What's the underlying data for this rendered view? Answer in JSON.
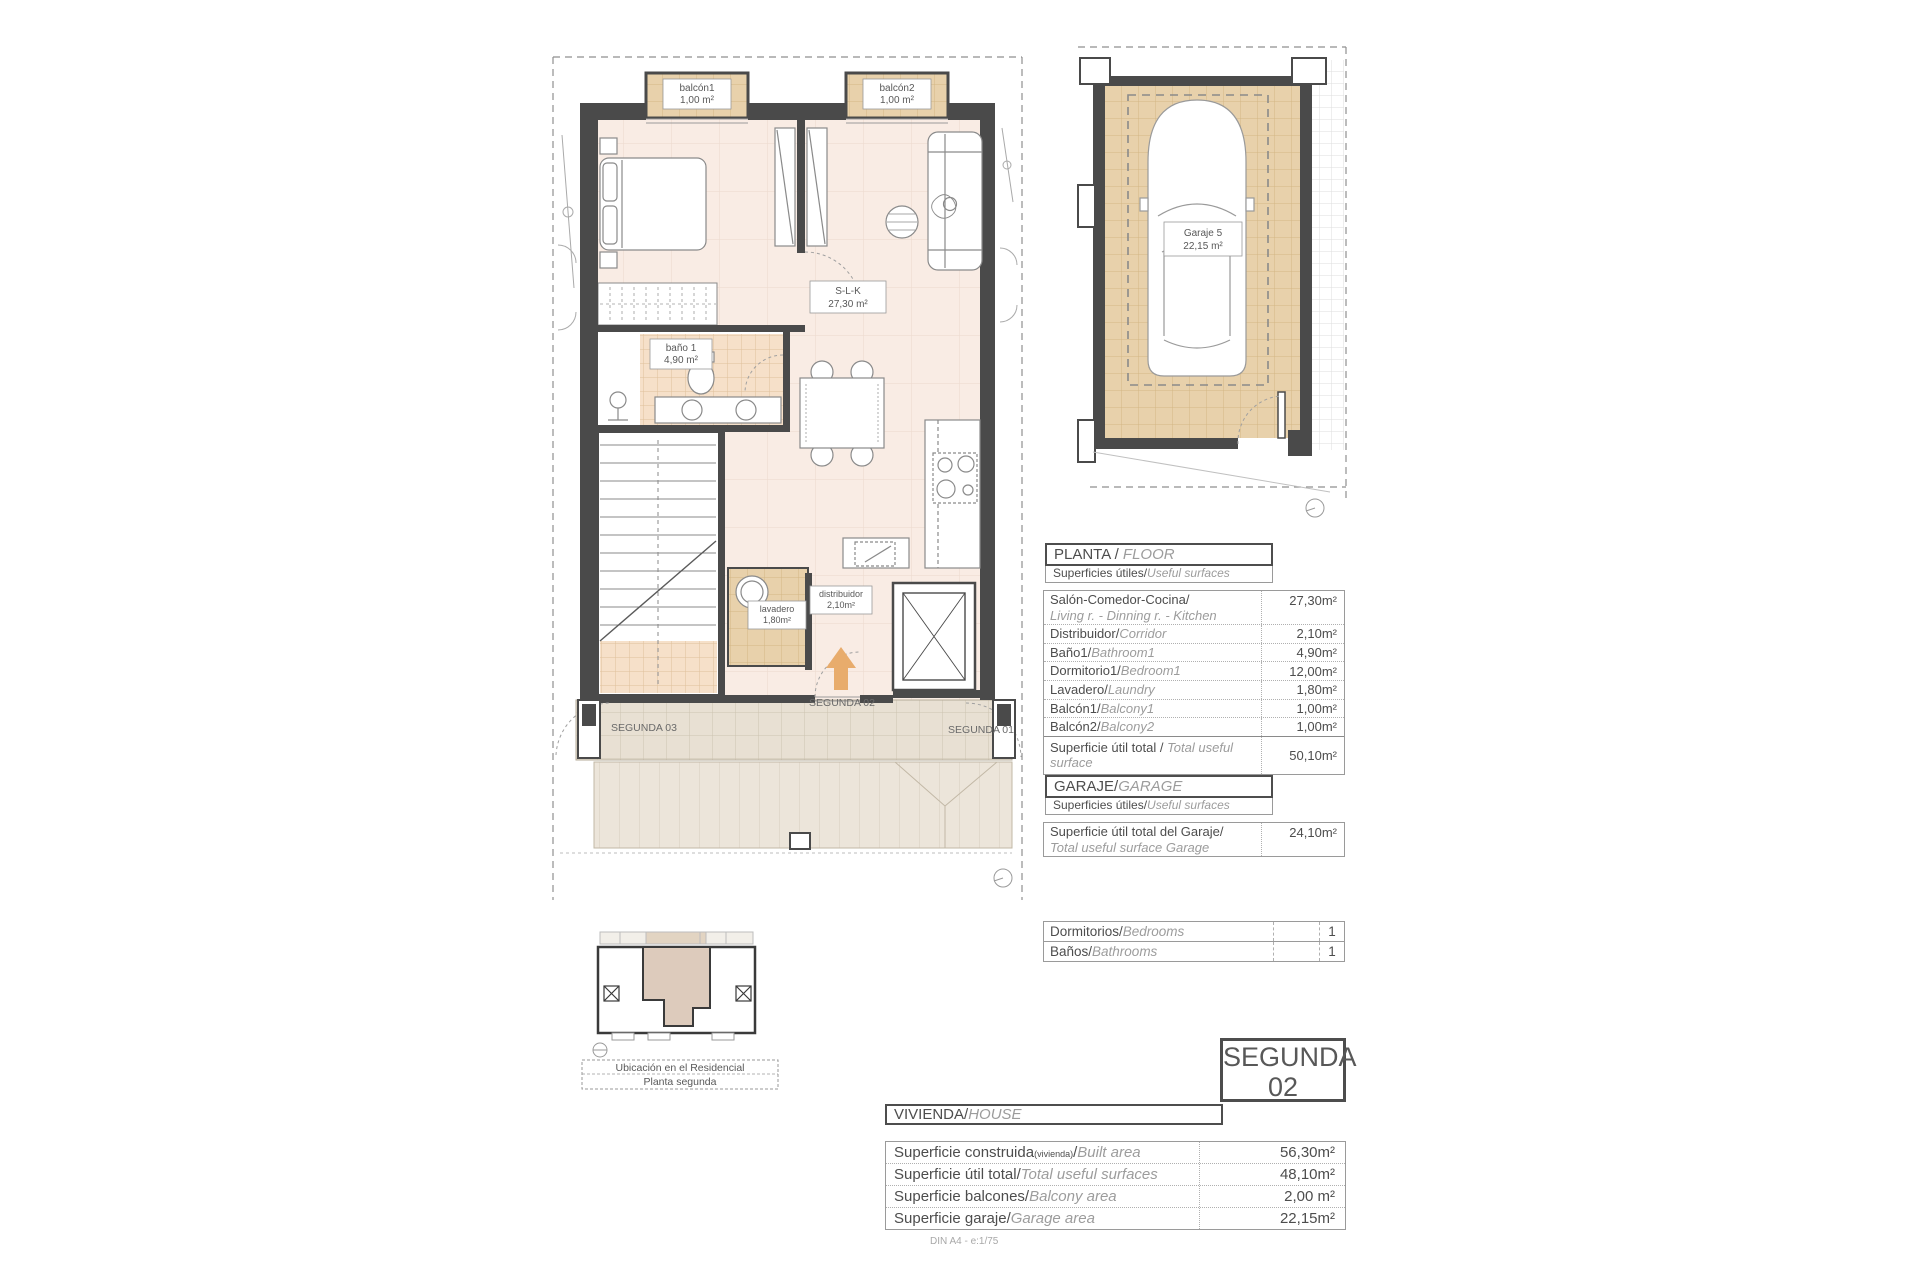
{
  "floor_plan": {
    "balcony1_name": "balcón1",
    "balcony1_area": "1,00 m²",
    "balcony2_name": "balcón2",
    "balcony2_area": "1,00 m²",
    "slk_name": "S-L-K",
    "slk_area": "27,30 m²",
    "bath_name": "baño 1",
    "bath_area": "4,90 m²",
    "laundry_name": "lavadero",
    "laundry_area": "1,80m²",
    "corridor_name": "distribuidor",
    "corridor_area": "2,10m²",
    "unit_label_left": "SEGUNDA 03",
    "unit_label_center": "SEGUNDA 02",
    "unit_label_right": "SEGUNDA 01"
  },
  "garage_plan": {
    "name": "Garaje 5",
    "area": "22,15 m²"
  },
  "floor_table": {
    "title": "PLANTA / ",
    "title_en": "FLOOR",
    "subtitle": "Superficies útiles/",
    "subtitle_en": "Useful surfaces",
    "rows": [
      {
        "es": "Salón-Comedor-Cocina/",
        "en": "Living r. - Dinning r. - Kitchen",
        "value": "27,30m²"
      },
      {
        "es": "Distribuidor/",
        "en": "Corridor",
        "value": "2,10m²"
      },
      {
        "es": "Baño1/",
        "en": "Bathroom1",
        "value": "4,90m²"
      },
      {
        "es": "Dormitorio1/",
        "en": "Bedroom1",
        "value": "12,00m²"
      },
      {
        "es": "Lavadero/",
        "en": "Laundry",
        "value": "1,80m²"
      },
      {
        "es": "Balcón1/",
        "en": "Balcony1",
        "value": "1,00m²"
      },
      {
        "es": "Balcón2/",
        "en": "Balcony2",
        "value": "1,00m²"
      }
    ],
    "total_es": "Superficie útil total / ",
    "total_en": "Total useful surface",
    "total_value": "50,10m²"
  },
  "garage_table": {
    "title": "GARAJE/",
    "title_en": "GARAGE",
    "subtitle": "Superficies útiles/",
    "subtitle_en": "Useful surfaces",
    "row_es": "Superficie útil total del Garaje/",
    "row_en": "Total useful surface Garage",
    "row_value": "24,10m²"
  },
  "counts_table": {
    "rows": [
      {
        "es": "Dormitorios/",
        "en": "Bedrooms",
        "value": "1"
      },
      {
        "es": "Baños/",
        "en": "Bathrooms",
        "value": "1"
      }
    ]
  },
  "unit_badge": {
    "line1": "SEGUNDA",
    "line2": "02"
  },
  "house_table": {
    "title": "VIVIENDA/",
    "title_en": "HOUSE",
    "rows": [
      {
        "es": "Superficie construida",
        "small": "(vivienda)",
        "slash": "/",
        "en": "Built area",
        "value": "56,30m²"
      },
      {
        "es": "Superficie útil total/",
        "en": "Total useful surfaces",
        "value": "48,10m²"
      },
      {
        "es": "Superficie balcones/",
        "en": "Balcony area",
        "value": "2,00 m²"
      },
      {
        "es": "Superficie garaje/",
        "en": "Garage area",
        "value": "22,15m²"
      }
    ]
  },
  "location_map": {
    "line1": "Ubicación en el Residencial",
    "line2": "Planta segunda"
  },
  "footer_note": "DIN A4 - e:1/75",
  "colors": {
    "floor_fill": "#f9ece4",
    "tile_tan": "#e8d1ab",
    "bath_tile": "#f6e0c9",
    "terrace": "#e8e0d3",
    "wall": "#4a4a4a",
    "arrow_accent": "#e8ac6c"
  }
}
